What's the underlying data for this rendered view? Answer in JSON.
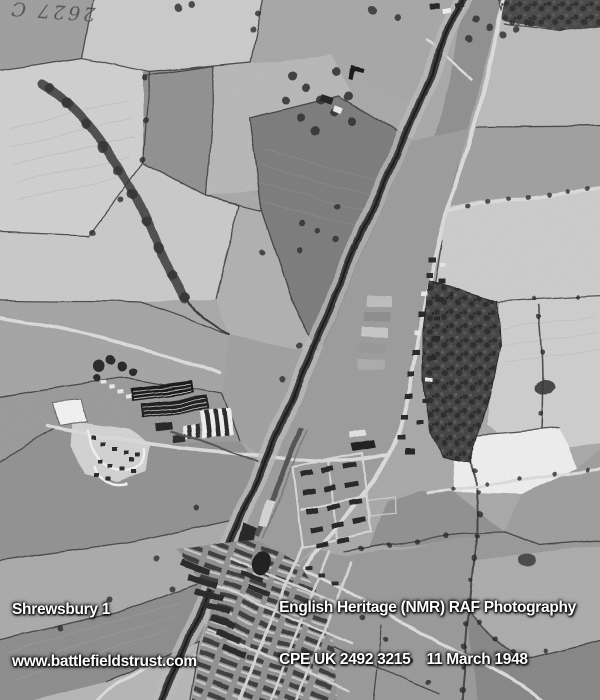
{
  "overlay": {
    "bottom_left": {
      "title": "Shrewsbury 1",
      "url": "www.battlefieldstrust.com"
    },
    "bottom_right": {
      "credit": "English Heritage (NMR) RAF Photography",
      "reference": "CPE UK 2492 3215    11 March 1948"
    },
    "handwritten_annotation": "2627 C"
  },
  "photo": {
    "subject": "Black-and-white vertical RAF aerial photograph of farmland, railway, army camp and housing at Shrewsbury",
    "colors": {
      "overlay_text": "#ffffff",
      "overlay_shadow": "#000000",
      "annotation_ink": "#3f3f3f"
    }
  }
}
